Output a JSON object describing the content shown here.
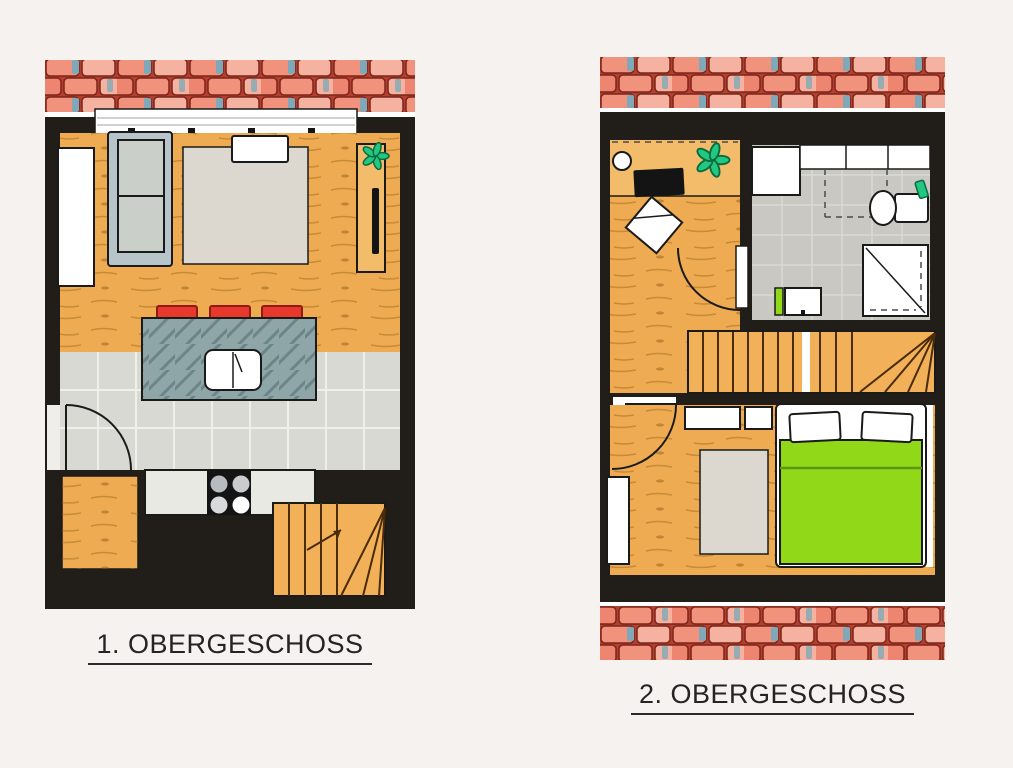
{
  "page": {
    "background": "#f5f2ef",
    "type": "architectural-floor-plans"
  },
  "plans": [
    {
      "id": "plan-1",
      "caption": "1. OBERGESCHOSS",
      "elements": [
        "roof-tile-band",
        "window-front",
        "wardrobe",
        "sofa",
        "area-rug",
        "coffee-table",
        "tv-sideboard",
        "tv",
        "plant",
        "kitchen-island",
        "bar-stools",
        "island-sink",
        "kitchen-tile-floor",
        "entry-door",
        "kitchen-counter",
        "cooktop",
        "entry-landing",
        "winder-staircase"
      ]
    },
    {
      "id": "plan-2",
      "caption": "2. OBERGESCHOSS",
      "elements": [
        "roof-tile-band-top",
        "desk",
        "desk-lamp",
        "laptop",
        "desk-chair",
        "plant",
        "office-door",
        "washing-machine",
        "bathroom-counter",
        "sloped-ceiling-dashed-line",
        "toilet",
        "towel",
        "shower",
        "bathroom-sink",
        "staircase",
        "hallway",
        "bedroom-door",
        "bedside-tables",
        "wardrobe",
        "bedroom-rug",
        "double-bed",
        "pillows",
        "roof-tile-band-bottom"
      ]
    }
  ],
  "colors": {
    "bg": "#f5f2ef",
    "wall": "#211e1a",
    "outline": "#1a1a1a",
    "wood": "#eeab52",
    "woodLight": "#f3bc6b",
    "stairWood": "#f2b159",
    "grainStroke": "#a06a1c",
    "tileFloor": "#d9d9d4",
    "grout": "#efefeb",
    "bathFloor": "#cac8c2",
    "bathGrout": "#dbd9d3",
    "counter": "#e9e9e4",
    "sofaFrame": "#b7c4ca",
    "sofaCushion": "#cbcfc9",
    "rug": "#dcd8cf",
    "islandBase": "#8fa6a8",
    "islandStreak": "#4e6a6e",
    "stoolRed": "#e8382b",
    "bedGreen": "#90d818",
    "bedGreenDark": "#5a9812",
    "plantGreen": "#22c87f",
    "roofBase": "#b3402e",
    "roofTileA": "#f1927c",
    "roofTileB": "#f5b2a0",
    "roofTileC": "#ee8570",
    "roofBlue": "#7fa9b8",
    "roofLine": "#7c241a"
  }
}
